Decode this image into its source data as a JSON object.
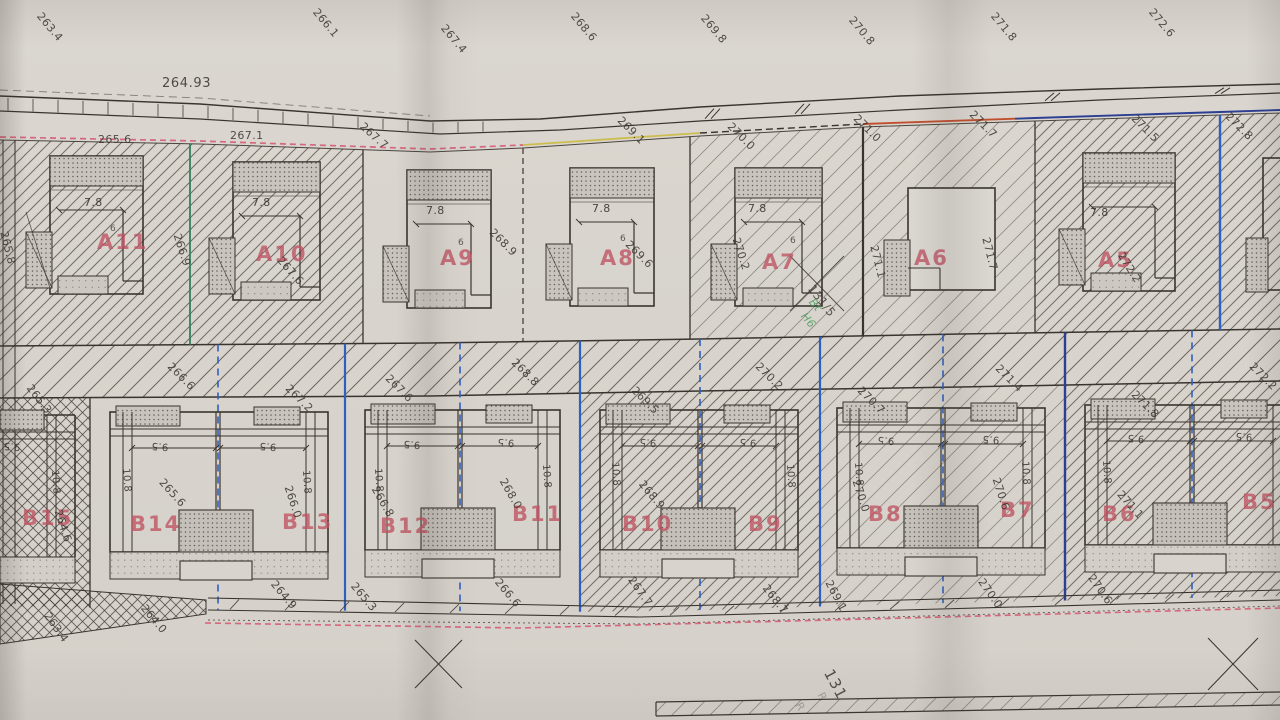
{
  "colors": {
    "paper": "#d8d4cd",
    "ink": "#39352e",
    "label_red": "#bf5262",
    "green": "#35805a",
    "blue": "#2f5fc0",
    "navy": "#2c3f93",
    "red": "#c04f2e",
    "yellow": "#cdbd4e",
    "pink": "#d4687e",
    "hand_green": "#3f9b57"
  },
  "annotations": {
    "top_margin": [
      {
        "t": "263.4",
        "x": 44,
        "y": 10,
        "r": 50
      },
      {
        "t": "266.1",
        "x": 320,
        "y": 6,
        "r": 50
      },
      {
        "t": "267.4",
        "x": 448,
        "y": 22,
        "r": 50
      },
      {
        "t": "268.6",
        "x": 578,
        "y": 10,
        "r": 50
      },
      {
        "t": "269.8",
        "x": 708,
        "y": 12,
        "r": 50
      },
      {
        "t": "270.8",
        "x": 856,
        "y": 14,
        "r": 50
      },
      {
        "t": "271.8",
        "x": 998,
        "y": 10,
        "r": 50
      },
      {
        "t": "272.6",
        "x": 1156,
        "y": 6,
        "r": 50
      },
      {
        "t": "264.93",
        "x": 162,
        "y": 76,
        "r": 0,
        "c": "bench"
      }
    ],
    "upper_boundary": [
      {
        "t": "265.6",
        "x": 98,
        "y": 133,
        "r": 0
      },
      {
        "t": "267.1",
        "x": 230,
        "y": 129,
        "r": 0
      },
      {
        "t": "267.7",
        "x": 366,
        "y": 120,
        "r": 42
      },
      {
        "t": "269.1",
        "x": 624,
        "y": 114,
        "r": 45
      },
      {
        "t": "270.0",
        "x": 734,
        "y": 120,
        "r": 45
      },
      {
        "t": "271.0",
        "x": 860,
        "y": 112,
        "r": 45
      },
      {
        "t": "271.7",
        "x": 976,
        "y": 108,
        "r": 45
      },
      {
        "t": "271.5",
        "x": 1138,
        "y": 112,
        "r": 45
      },
      {
        "t": "272.8",
        "x": 1232,
        "y": 110,
        "r": 45
      }
    ],
    "plots_top": [
      {
        "t": "A11",
        "x": 97,
        "y": 230,
        "c": "plot"
      },
      {
        "t": "7.8",
        "x": 84,
        "y": 196,
        "c": "dim"
      },
      {
        "t": "6",
        "x": 110,
        "y": 224,
        "c": "tiny"
      },
      {
        "t": "265.8",
        "x": 10,
        "y": 230,
        "r": 76
      },
      {
        "t": "266.9",
        "x": 183,
        "y": 232,
        "r": 72
      },
      {
        "t": "A10",
        "x": 256,
        "y": 242,
        "c": "plot"
      },
      {
        "t": "7.8",
        "x": 252,
        "y": 196,
        "c": "dim"
      },
      {
        "t": "267.6",
        "x": 284,
        "y": 254,
        "r": 48
      },
      {
        "t": "A9",
        "x": 440,
        "y": 246,
        "c": "plot"
      },
      {
        "t": "7.8",
        "x": 426,
        "y": 204,
        "c": "dim"
      },
      {
        "t": "6",
        "x": 458,
        "y": 238,
        "c": "tiny"
      },
      {
        "t": "268.9",
        "x": 496,
        "y": 226,
        "r": 45
      },
      {
        "t": "A8",
        "x": 600,
        "y": 246,
        "c": "plot"
      },
      {
        "t": "7.8",
        "x": 592,
        "y": 202,
        "c": "dim"
      },
      {
        "t": "6",
        "x": 620,
        "y": 234,
        "c": "tiny"
      },
      {
        "t": "269.6",
        "x": 632,
        "y": 238,
        "r": 45
      },
      {
        "t": "A7",
        "x": 762,
        "y": 250,
        "c": "plot"
      },
      {
        "t": "7.8",
        "x": 748,
        "y": 202,
        "c": "dim"
      },
      {
        "t": "6",
        "x": 790,
        "y": 236,
        "c": "tiny"
      },
      {
        "t": "270.2",
        "x": 742,
        "y": 236,
        "r": 72
      },
      {
        "t": "131/5",
        "x": 816,
        "y": 282,
        "r": 52,
        "c": "ref"
      },
      {
        "t": "Bt",
        "x": 816,
        "y": 296,
        "r": 50,
        "c": "hand"
      },
      {
        "t": "H6",
        "x": 808,
        "y": 310,
        "r": 50,
        "c": "hand"
      },
      {
        "t": "A6",
        "x": 914,
        "y": 246,
        "c": "plot"
      },
      {
        "t": "271.1",
        "x": 880,
        "y": 244,
        "r": 76
      },
      {
        "t": "271.7",
        "x": 992,
        "y": 236,
        "r": 76
      },
      {
        "t": "A5",
        "x": 1098,
        "y": 248,
        "c": "plot"
      },
      {
        "t": "7.8",
        "x": 1090,
        "y": 206,
        "c": "dim"
      },
      {
        "t": "272.2",
        "x": 1126,
        "y": 250,
        "r": 58
      }
    ],
    "mid_road": [
      {
        "t": "265.3",
        "x": 34,
        "y": 382,
        "r": 52
      },
      {
        "t": "266.6",
        "x": 174,
        "y": 360,
        "r": 45
      },
      {
        "t": "267.2",
        "x": 292,
        "y": 382,
        "r": 45
      },
      {
        "t": "267.6",
        "x": 392,
        "y": 372,
        "r": 45
      },
      {
        "t": "268.8",
        "x": 518,
        "y": 356,
        "r": 45
      },
      {
        "t": "269.5",
        "x": 638,
        "y": 384,
        "r": 45
      },
      {
        "t": "270.2",
        "x": 762,
        "y": 360,
        "r": 45
      },
      {
        "t": "270.7",
        "x": 864,
        "y": 384,
        "r": 45
      },
      {
        "t": "271.4",
        "x": 1002,
        "y": 362,
        "r": 45
      },
      {
        "t": "271.8",
        "x": 1138,
        "y": 388,
        "r": 45
      },
      {
        "t": "272.2",
        "x": 1256,
        "y": 360,
        "r": 45
      }
    ],
    "plots_bottom": [
      {
        "t": "B15",
        "x": 22,
        "y": 506,
        "c": "plot"
      },
      {
        "t": "B14",
        "x": 130,
        "y": 512,
        "c": "plot"
      },
      {
        "t": "B13",
        "x": 282,
        "y": 510,
        "c": "plot"
      },
      {
        "t": "B12",
        "x": 380,
        "y": 514,
        "c": "plot"
      },
      {
        "t": "B11",
        "x": 512,
        "y": 502,
        "c": "plot"
      },
      {
        "t": "B10",
        "x": 622,
        "y": 512,
        "c": "plot"
      },
      {
        "t": "B9",
        "x": 748,
        "y": 512,
        "c": "plot"
      },
      {
        "t": "B8",
        "x": 868,
        "y": 502,
        "c": "plot"
      },
      {
        "t": "B7",
        "x": 1000,
        "y": 498,
        "c": "plot"
      },
      {
        "t": "B6",
        "x": 1102,
        "y": 502,
        "c": "plot"
      },
      {
        "t": "B5",
        "x": 1242,
        "y": 490,
        "c": "plot"
      },
      {
        "t": "9.5",
        "x": 20,
        "y": 452,
        "c": "dimf"
      },
      {
        "t": "9.5",
        "x": 168,
        "y": 452,
        "c": "dimf"
      },
      {
        "t": "9.5",
        "x": 276,
        "y": 452,
        "c": "dimf"
      },
      {
        "t": "9.5",
        "x": 420,
        "y": 450,
        "c": "dimf"
      },
      {
        "t": "9.5",
        "x": 514,
        "y": 448,
        "c": "dimf"
      },
      {
        "t": "9.5",
        "x": 656,
        "y": 448,
        "c": "dimf"
      },
      {
        "t": "9.5",
        "x": 756,
        "y": 448,
        "c": "dimf"
      },
      {
        "t": "9.5",
        "x": 894,
        "y": 446,
        "c": "dimf"
      },
      {
        "t": "9.5",
        "x": 999,
        "y": 445,
        "c": "dimf"
      },
      {
        "t": "9.5",
        "x": 1144,
        "y": 444,
        "c": "dimf"
      },
      {
        "t": "9.5",
        "x": 1252,
        "y": 442,
        "c": "dimf"
      },
      {
        "t": "10.8",
        "x": 60,
        "y": 470,
        "c": "dimv"
      },
      {
        "t": "10.8",
        "x": 131,
        "y": 468,
        "c": "dimv"
      },
      {
        "t": "10.8",
        "x": 311,
        "y": 470,
        "c": "dimv"
      },
      {
        "t": "10.8",
        "x": 383,
        "y": 468,
        "c": "dimv"
      },
      {
        "t": "10.8",
        "x": 551,
        "y": 464,
        "c": "dimv"
      },
      {
        "t": "10.8",
        "x": 620,
        "y": 462,
        "c": "dimv"
      },
      {
        "t": "10.8",
        "x": 795,
        "y": 464,
        "c": "dimv"
      },
      {
        "t": "10.8",
        "x": 863,
        "y": 462,
        "c": "dimv"
      },
      {
        "t": "10.8",
        "x": 1030,
        "y": 461,
        "c": "dimv"
      },
      {
        "t": "10.8",
        "x": 1111,
        "y": 460,
        "c": "dimv"
      },
      {
        "t": "264.6",
        "x": 64,
        "y": 508,
        "r": 72
      },
      {
        "t": "265.6",
        "x": 166,
        "y": 476,
        "r": 48
      },
      {
        "t": "266.0",
        "x": 294,
        "y": 484,
        "r": 72
      },
      {
        "t": "266.8",
        "x": 380,
        "y": 484,
        "r": 60
      },
      {
        "t": "268.0",
        "x": 508,
        "y": 476,
        "r": 60
      },
      {
        "t": "268.9",
        "x": 646,
        "y": 478,
        "r": 50
      },
      {
        "t": "270.0",
        "x": 862,
        "y": 478,
        "r": 72
      },
      {
        "t": "270.6",
        "x": 1002,
        "y": 476,
        "r": 72
      },
      {
        "t": "271.1",
        "x": 1124,
        "y": 488,
        "r": 48
      }
    ],
    "lower_boundary": [
      {
        "t": "263.4",
        "x": 52,
        "y": 610,
        "r": 55
      },
      {
        "t": "264.0",
        "x": 148,
        "y": 602,
        "r": 50
      },
      {
        "t": "264.9",
        "x": 278,
        "y": 578,
        "r": 50
      },
      {
        "t": "265.3",
        "x": 358,
        "y": 580,
        "r": 50
      },
      {
        "t": "266.6",
        "x": 502,
        "y": 576,
        "r": 50
      },
      {
        "t": "267.7",
        "x": 636,
        "y": 574,
        "r": 55
      },
      {
        "t": "268.7",
        "x": 770,
        "y": 582,
        "r": 52
      },
      {
        "t": "269.1",
        "x": 834,
        "y": 578,
        "r": 62
      },
      {
        "t": "270.0",
        "x": 986,
        "y": 576,
        "r": 55
      },
      {
        "t": "270.6",
        "x": 1096,
        "y": 572,
        "r": 55
      }
    ],
    "misc": [
      {
        "t": "131",
        "x": 836,
        "y": 666,
        "r": 62,
        "c": "sheet"
      },
      {
        "t": "R",
        "x": 826,
        "y": 690,
        "r": 62,
        "c": "faint"
      },
      {
        "t": "R",
        "x": 804,
        "y": 700,
        "r": 62,
        "c": "faint"
      }
    ]
  }
}
